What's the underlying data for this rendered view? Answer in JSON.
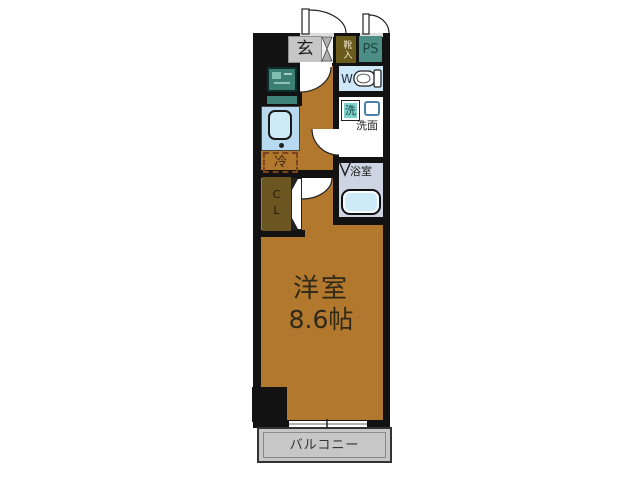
{
  "plan": {
    "entrance": {
      "label": "玄"
    },
    "shoe_box": {
      "label": "靴入"
    },
    "pipe_space": {
      "label": "PS"
    },
    "toilet": {
      "label": "WC"
    },
    "laundry": {
      "label": "洗"
    },
    "washroom": {
      "label": "洗面"
    },
    "bathroom": {
      "label": "浴室"
    },
    "refrigerator": {
      "label": "冷"
    },
    "closet": {
      "label": "CL"
    },
    "main_room": {
      "label": "洋室",
      "size": "8.6帖"
    },
    "balcony": {
      "label": "バルコニー"
    },
    "colors": {
      "floor": "#b2782e",
      "wall": "#121212",
      "genkan": "#c6c6c6",
      "shoebox": "#6a5a1c",
      "ps": "#4c8e85",
      "wc": "#cfe8f8",
      "laundry": "#7fd0ca",
      "bathroom": "#ccd5e1",
      "bathtub": "#cfeaf7",
      "kitchen": "#b8daf0",
      "closet": "#6b5520",
      "balcony": "#c7c7c7",
      "fridge_border": "#7c441c",
      "equipment_teal": "#3c7d74"
    }
  }
}
